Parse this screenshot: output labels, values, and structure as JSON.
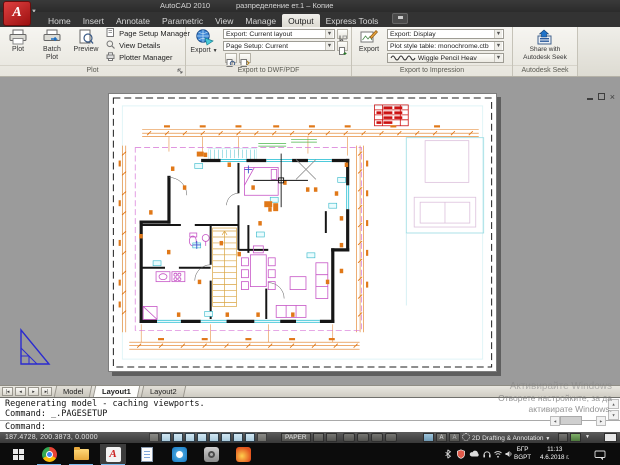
{
  "titlebar": {
    "app_name": "AutoCAD 2010",
    "doc_name": "разпределение ет.1 – Копие"
  },
  "ribbon": {
    "tabs": [
      "Home",
      "Insert",
      "Annotate",
      "Parametric",
      "View",
      "Manage",
      "Output",
      "Express Tools"
    ],
    "active_tab": "Output",
    "plot_panel": {
      "plot": "Plot",
      "batch_line1": "Batch",
      "batch_line2": "Plot",
      "preview": "Preview",
      "page_setup_manager": "Page Setup Manager",
      "view_details": "View Details",
      "plotter_manager": "Plotter Manager",
      "footer": "Plot"
    },
    "dwf_panel": {
      "export": "Export",
      "row1": "Export: Current layout",
      "row2": "Page Setup: Current",
      "footer": "Export to DWF/PDF"
    },
    "impression_panel": {
      "export": "Export",
      "row1": "Export: Display",
      "row2": "Plot style table: monochrome.ctb",
      "row3": "Wiggle Pencil Heav",
      "footer": "Export to Impression"
    },
    "seek_panel": {
      "share_line1": "Share with",
      "share_line2": "Autodesk Seek",
      "footer": "Autodesk Seek"
    }
  },
  "layout_bar": {
    "model": "Model",
    "layout1": "Layout1",
    "layout2": "Layout2"
  },
  "command_window": {
    "history_1": "Regenerating model - caching viewports.",
    "history_2": "Command: _.PAGESETUP",
    "prompt": "Command:"
  },
  "watermark": {
    "line1": "Активирайте Windows",
    "line2": "Отворете настройките, за да",
    "line3": "активирате Windows."
  },
  "status_bar": {
    "coordinates": "187.4728, 200.3873, 0.0000",
    "paper": "PAPER",
    "workspace": "2D Drafting & Annotation"
  },
  "taskbar": {
    "lang_line1": "БГР",
    "lang_line2": "BGPT",
    "time": "11:13",
    "date": "4.6.2018 г."
  },
  "colors": {
    "dimension_orange": "#e07818",
    "wall_black": "#161616",
    "furniture_magenta": "#c655c6",
    "window_cyan": "#35c3d6",
    "titleblock_red": "#cc1111",
    "paper_white": "#ffffff",
    "canvas_gray": "#9b9b9b",
    "ucs_blue": "#2b2bd0"
  }
}
